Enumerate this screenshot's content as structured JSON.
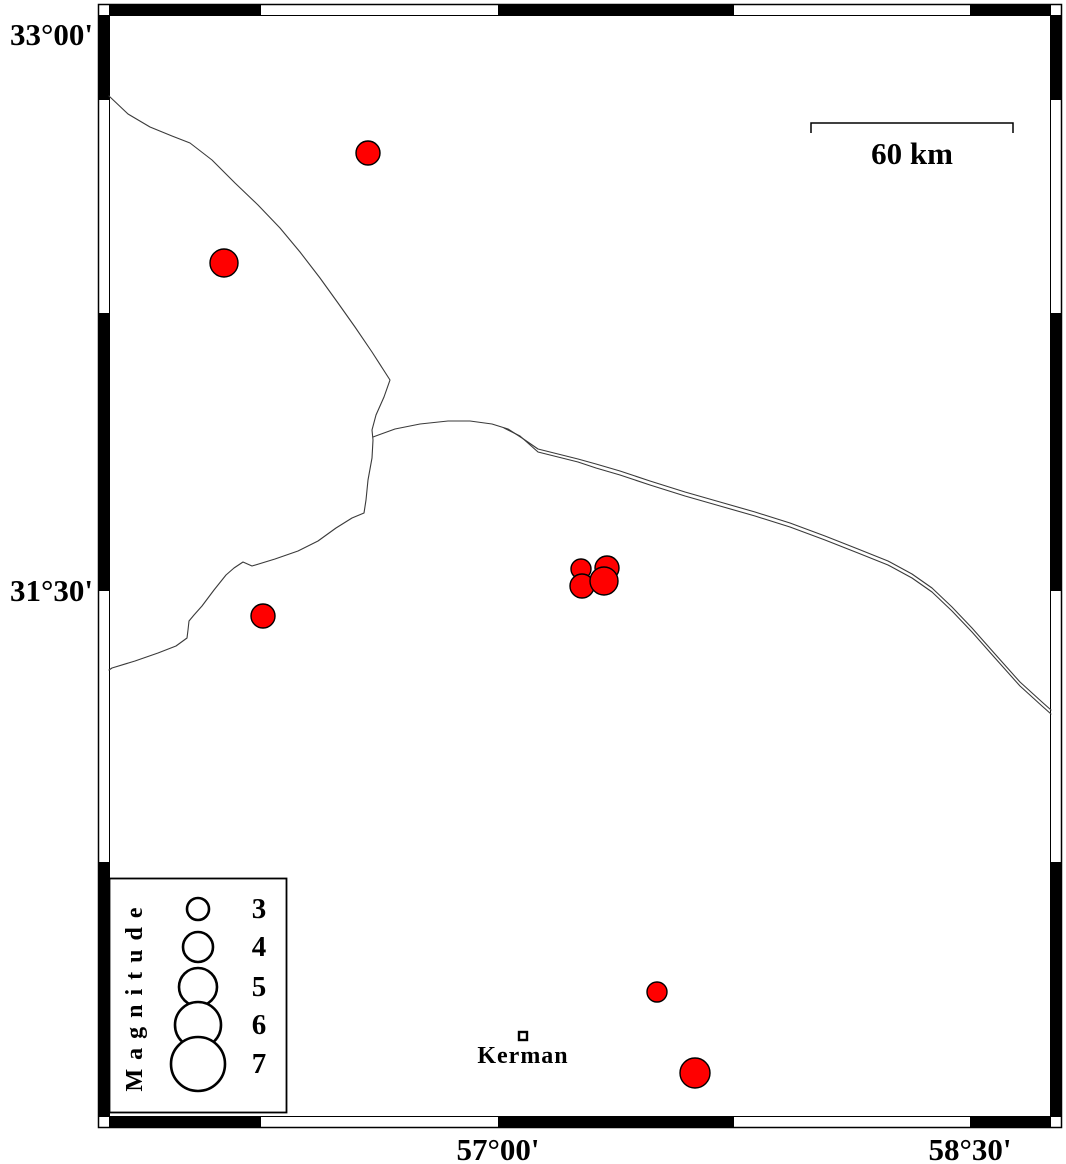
{
  "map_data": {
    "type": "scatter-map",
    "description_visible_text_only": "seismicity map with magnitude-scaled epicenter symbols",
    "lat_ticks": [
      {
        "label": "33°00'",
        "y_px": 35
      },
      {
        "label": "31°30'",
        "y_px": 591
      }
    ],
    "lon_ticks": [
      {
        "label": "57°00'",
        "x_px": 498
      },
      {
        "label": "58°30'",
        "x_px": 970
      }
    ],
    "scale_bar": {
      "label": "60 km",
      "length_km": 60,
      "x1_px": 811,
      "x2_px": 1013,
      "y_px": 123
    },
    "city": {
      "name": "Kerman",
      "x_px": 523,
      "y_px": 1036,
      "lon": 57.08,
      "lat": 30.29
    },
    "legend": {
      "title": "Magnitude",
      "symbol": "circle",
      "entries": [
        {
          "magnitude": 3,
          "r_px": 11,
          "y_px": 909
        },
        {
          "magnitude": 4,
          "r_px": 15,
          "y_px": 947
        },
        {
          "magnitude": 5,
          "r_px": 19,
          "y_px": 987
        },
        {
          "magnitude": 6,
          "r_px": 23,
          "y_px": 1025
        },
        {
          "magnitude": 7,
          "r_px": 27,
          "y_px": 1064
        }
      ],
      "circle_column_x_px": 198
    },
    "epicenters": [
      {
        "x_px": 368,
        "y_px": 153,
        "r_px": 12,
        "lon": 56.59,
        "lat": 32.68,
        "magnitude": 3.3
      },
      {
        "x_px": 224,
        "y_px": 263,
        "r_px": 14,
        "lon": 56.13,
        "lat": 32.39,
        "magnitude": 3.8
      },
      {
        "x_px": 263,
        "y_px": 616,
        "r_px": 12,
        "lon": 56.25,
        "lat": 31.43,
        "magnitude": 3.3
      },
      {
        "x_px": 581,
        "y_px": 569,
        "r_px": 10,
        "lon": 57.26,
        "lat": 31.56,
        "magnitude": 3.0
      },
      {
        "x_px": 607,
        "y_px": 568,
        "r_px": 12,
        "lon": 57.35,
        "lat": 31.56,
        "magnitude": 3.3
      },
      {
        "x_px": 582,
        "y_px": 586,
        "r_px": 12,
        "lon": 57.27,
        "lat": 31.51,
        "magnitude": 3.3
      },
      {
        "x_px": 604,
        "y_px": 581,
        "r_px": 14,
        "lon": 57.34,
        "lat": 31.53,
        "magnitude": 3.8
      },
      {
        "x_px": 657,
        "y_px": 992,
        "r_px": 10,
        "lon": 57.51,
        "lat": 30.41,
        "magnitude": 3.0
      },
      {
        "x_px": 695,
        "y_px": 1073,
        "r_px": 15,
        "lon": 57.63,
        "lat": 30.19,
        "magnitude": 4.0
      }
    ],
    "colors": {
      "epicenter_fill": "#ff0000",
      "epicenter_stroke": "#000000",
      "geo_line": "#3a3a3a",
      "frame": "#000000",
      "background": "#ffffff"
    }
  }
}
